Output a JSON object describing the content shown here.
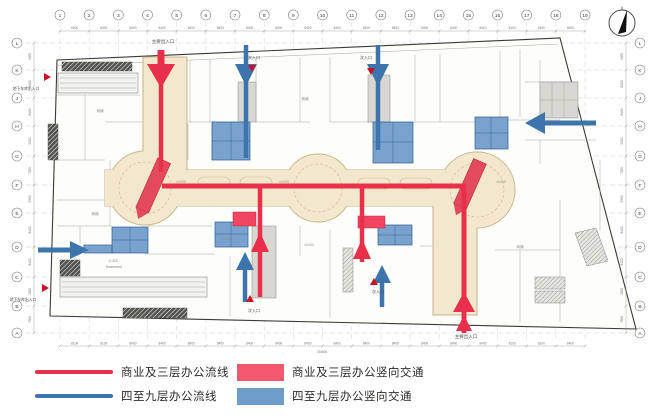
{
  "legend": {
    "items": [
      {
        "style": "line",
        "color": "#e9304a",
        "label": "商业及三层办公流线"
      },
      {
        "style": "line",
        "color": "#3d74ac",
        "label": "四至九层办公流线"
      },
      {
        "style": "block",
        "color": "#f2586e",
        "label": "商业及三层办公竖向交通"
      },
      {
        "style": "block",
        "color": "#6d9dc8",
        "label": "四至九层办公竖向交通"
      }
    ]
  },
  "grid": {
    "columns": [
      "1",
      "2",
      "3",
      "4",
      "5",
      "6",
      "7",
      "8",
      "9",
      "10",
      "11",
      "12",
      "13",
      "14",
      "15",
      "16",
      "17",
      "18",
      "19"
    ],
    "rows": [
      "L",
      "K",
      "J",
      "H",
      "G",
      "F",
      "E",
      "D",
      "C",
      "B",
      "A"
    ],
    "row_y": [
      43,
      70,
      98,
      126,
      156,
      185,
      213,
      247,
      277,
      306,
      333
    ]
  },
  "dimensions": {
    "top": [
      "8400",
      "8400",
      "8400",
      "8400",
      "8400",
      "8400",
      "8400",
      "8400",
      "8400",
      "8400",
      "8400",
      "8400",
      "8400",
      "8400",
      "8400",
      "8100",
      "8100",
      "8400"
    ],
    "bottom": [
      "8100",
      "8100",
      "8400",
      "8400",
      "8400",
      "8400",
      "8400",
      "8400",
      "8400",
      "8400",
      "8400",
      "8400",
      "8400",
      "8400",
      "8400",
      "8100",
      "8100",
      "8400"
    ],
    "left": [
      "5200",
      "8400",
      "8400",
      "5300",
      "7500",
      "5300",
      "8400",
      "8400",
      "4500",
      "7500"
    ],
    "right": [
      "5200",
      "8400",
      "8400",
      "5300",
      "7500",
      "5300",
      "8400",
      "8400",
      "4500",
      "7500"
    ],
    "total": "150800"
  },
  "labels": {
    "entrances": [
      {
        "text": "主要出入口",
        "x": 163,
        "y": 43,
        "size": 4.5
      },
      {
        "text": "次入口",
        "x": 254,
        "y": 59,
        "size": 4
      },
      {
        "text": "次入口",
        "x": 366,
        "y": 59,
        "size": 4
      },
      {
        "text": "主要出入口",
        "x": 466,
        "y": 338,
        "size": 4.5
      },
      {
        "text": "次入口",
        "x": 254,
        "y": 312,
        "size": 4
      },
      {
        "text": "次入口",
        "x": 378,
        "y": 293,
        "size": 4
      },
      {
        "text": "地下车库出入口",
        "x": 26,
        "y": 90,
        "size": 3.8
      },
      {
        "text": "地下车库出入口",
        "x": 23,
        "y": 301,
        "size": 3.8
      }
    ],
    "levels": [
      {
        "text": "±0.000",
        "x": 181,
        "y": 183
      },
      {
        "text": "±0.000",
        "x": 284,
        "y": 183
      },
      {
        "text": "±0.000",
        "x": 501,
        "y": 183
      },
      {
        "text": "±0.000",
        "x": 226,
        "y": 240
      },
      {
        "text": "±0.000",
        "x": 309,
        "y": 246
      }
    ],
    "rooms": [
      {
        "text": "商铺",
        "x": 100,
        "y": 112
      },
      {
        "text": "商铺",
        "x": 305,
        "y": 100
      },
      {
        "text": "商铺",
        "x": 95,
        "y": 215
      },
      {
        "text": "商铺",
        "x": 520,
        "y": 248
      },
      {
        "text": "-0.300",
        "x": 113,
        "y": 262
      },
      {
        "text": "Basement",
        "x": 114,
        "y": 268
      }
    ],
    "entrance_markers": [
      {
        "x": 44,
        "y": 77,
        "dir": "right"
      },
      {
        "x": 42,
        "y": 288,
        "dir": "right"
      },
      {
        "x": 252,
        "y": 65,
        "dir": "down"
      },
      {
        "x": 371,
        "y": 68,
        "dir": "down"
      },
      {
        "x": 250,
        "y": 302,
        "dir": "up"
      },
      {
        "x": 374,
        "y": 285,
        "dir": "up"
      }
    ]
  },
  "colors": {
    "red_flow": "#e9304a",
    "red_core": "#ee4560",
    "blue_flow": "#3d74ac",
    "blue_core": "#5b8fc4",
    "corridor": "#f3e8cd"
  }
}
